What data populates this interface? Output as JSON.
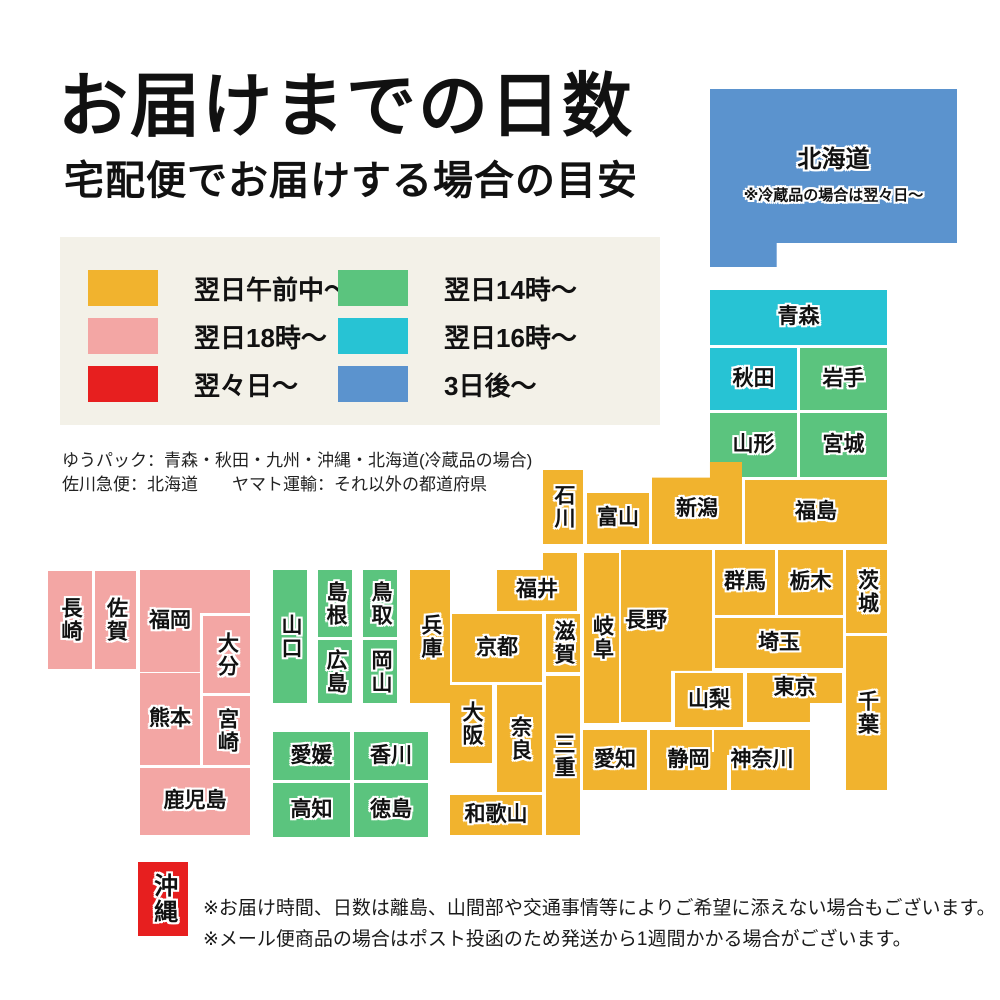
{
  "title": "お届けまでの日数",
  "subtitle": "宅配便でお届けする場合の目安",
  "legend": {
    "items": [
      {
        "id": "next_morning",
        "label": "翌日午前中〜",
        "color": "#f1b32e"
      },
      {
        "id": "next_18",
        "label": "翌日18時〜",
        "color": "#f3a6a4"
      },
      {
        "id": "next_next_day",
        "label": "翌々日〜",
        "color": "#e71f1f"
      },
      {
        "id": "next_14",
        "label": "翌日14時〜",
        "color": "#5bc47e"
      },
      {
        "id": "next_16",
        "label": "翌日16時〜",
        "color": "#27c3d4"
      },
      {
        "id": "three_days",
        "label": "3日後〜",
        "color": "#5b93ce"
      }
    ]
  },
  "carrier_notes": [
    "ゆうパック：青森・秋田・九州・沖縄・北海道(冷蔵品の場合)",
    "佐川急便：北海道　　ヤマト運輸：それ以外の都道府県"
  ],
  "hokkaido_note": "※冷蔵品の場合は翌々日〜",
  "footer_notes": [
    "※お届け時間、日数は離島、山間部や交通事情等によりご希望に添えない場合もございます。",
    "※メール便商品の場合はポスト投函のため発送から1週間かかる場合がございます。"
  ],
  "prefectures": [
    {
      "id": "hokkaido",
      "name": "北海道",
      "category": "three_days"
    },
    {
      "id": "aomori",
      "name": "青森",
      "category": "next_16"
    },
    {
      "id": "akita",
      "name": "秋田",
      "category": "next_16"
    },
    {
      "id": "iwate",
      "name": "岩手",
      "category": "next_14"
    },
    {
      "id": "yamagata",
      "name": "山形",
      "category": "next_14"
    },
    {
      "id": "miyagi",
      "name": "宮城",
      "category": "next_14"
    },
    {
      "id": "ishikawa",
      "name": "石川",
      "category": "next_morning"
    },
    {
      "id": "toyama",
      "name": "富山",
      "category": "next_morning"
    },
    {
      "id": "niigata",
      "name": "新潟",
      "category": "next_morning"
    },
    {
      "id": "fukushima",
      "name": "福島",
      "category": "next_morning"
    },
    {
      "id": "gunma",
      "name": "群馬",
      "category": "next_morning"
    },
    {
      "id": "tochigi",
      "name": "栃木",
      "category": "next_morning"
    },
    {
      "id": "ibaraki",
      "name": "茨城",
      "category": "next_morning"
    },
    {
      "id": "saitama",
      "name": "埼玉",
      "category": "next_morning"
    },
    {
      "id": "chiba",
      "name": "千葉",
      "category": "next_morning"
    },
    {
      "id": "yamanashi",
      "name": "山梨",
      "category": "next_morning"
    },
    {
      "id": "tokyo",
      "name": "東京",
      "category": "next_morning"
    },
    {
      "id": "kanagawa",
      "name": "神奈川",
      "category": "next_morning"
    },
    {
      "id": "shizuoka",
      "name": "静岡",
      "category": "next_morning"
    },
    {
      "id": "aichi",
      "name": "愛知",
      "category": "next_morning"
    },
    {
      "id": "nagano",
      "name": "長野",
      "category": "next_morning"
    },
    {
      "id": "gifu",
      "name": "岐阜",
      "category": "next_morning"
    },
    {
      "id": "fukui",
      "name": "福井",
      "category": "next_morning"
    },
    {
      "id": "kyoto",
      "name": "京都",
      "category": "next_morning"
    },
    {
      "id": "shiga",
      "name": "滋賀",
      "category": "next_morning"
    },
    {
      "id": "mie",
      "name": "三重",
      "category": "next_morning"
    },
    {
      "id": "osaka",
      "name": "大阪",
      "category": "next_morning"
    },
    {
      "id": "nara",
      "name": "奈良",
      "category": "next_morning"
    },
    {
      "id": "wakayama",
      "name": "和歌山",
      "category": "next_morning"
    },
    {
      "id": "hyogo",
      "name": "兵庫",
      "category": "next_morning"
    },
    {
      "id": "yamaguchi",
      "name": "山口",
      "category": "next_14"
    },
    {
      "id": "shimane",
      "name": "島根",
      "category": "next_14"
    },
    {
      "id": "tottori",
      "name": "鳥取",
      "category": "next_14"
    },
    {
      "id": "hiroshima",
      "name": "広島",
      "category": "next_14"
    },
    {
      "id": "okayama",
      "name": "岡山",
      "category": "next_14"
    },
    {
      "id": "ehime",
      "name": "愛媛",
      "category": "next_14"
    },
    {
      "id": "kagawa",
      "name": "香川",
      "category": "next_14"
    },
    {
      "id": "kochi",
      "name": "高知",
      "category": "next_14"
    },
    {
      "id": "tokushima",
      "name": "徳島",
      "category": "next_14"
    },
    {
      "id": "nagasaki",
      "name": "長崎",
      "category": "next_18"
    },
    {
      "id": "saga",
      "name": "佐賀",
      "category": "next_18"
    },
    {
      "id": "fukuoka",
      "name": "福岡",
      "category": "next_18"
    },
    {
      "id": "oita",
      "name": "大分",
      "category": "next_18"
    },
    {
      "id": "kumamoto",
      "name": "熊本",
      "category": "next_18"
    },
    {
      "id": "miyazaki",
      "name": "宮崎",
      "category": "next_18"
    },
    {
      "id": "kagoshima",
      "name": "鹿児島",
      "category": "next_18"
    },
    {
      "id": "okinawa",
      "name": "沖縄",
      "category": "next_next_day"
    }
  ]
}
